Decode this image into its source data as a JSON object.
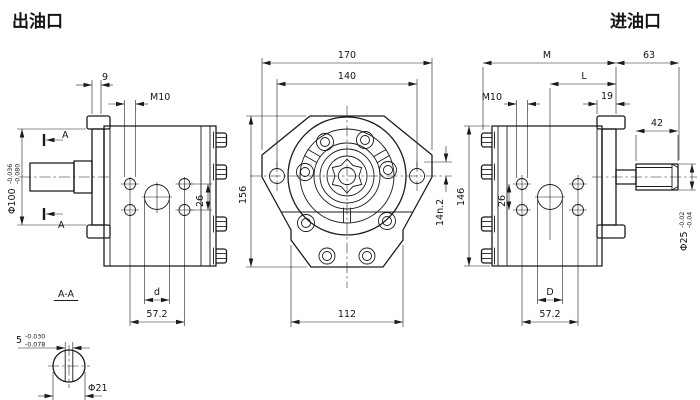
{
  "titles": {
    "outlet": "出油口",
    "inlet": "进油口"
  },
  "outlet_view": {
    "dim_flange_thickness": "9",
    "dim_thread": "M10",
    "dim_pilot": "Φ100",
    "pilot_tol_hi": "-0.036",
    "pilot_tol_lo": "-0.080",
    "dim_hole_v": "26",
    "dim_port": "d",
    "dim_holes_h": "57.2",
    "section_mark": "A"
  },
  "front_view": {
    "dim_overall_w": "170",
    "dim_bolt_span": "140",
    "dim_overall_h": "156",
    "dim_body_w": "112",
    "dim_ear_offset": "14n.2"
  },
  "inlet_view": {
    "dim_m": "M",
    "dim_end": "63",
    "dim_l": "L",
    "dim_tab": "19",
    "dim_thread": "M10",
    "dim_thread_len": "42",
    "dim_hole_v": "26",
    "dim_height": "146",
    "dim_shaft": "Φ25",
    "shaft_tol_hi": "-0.02",
    "shaft_tol_lo": "-0.04",
    "dim_port": "D",
    "dim_holes_h": "57.2"
  },
  "section_aa": {
    "title": "A-A",
    "dim_flat": "5",
    "flat_tol_hi": "-0.030",
    "flat_tol_lo": "-0.078",
    "dim_dia": "Φ21"
  }
}
